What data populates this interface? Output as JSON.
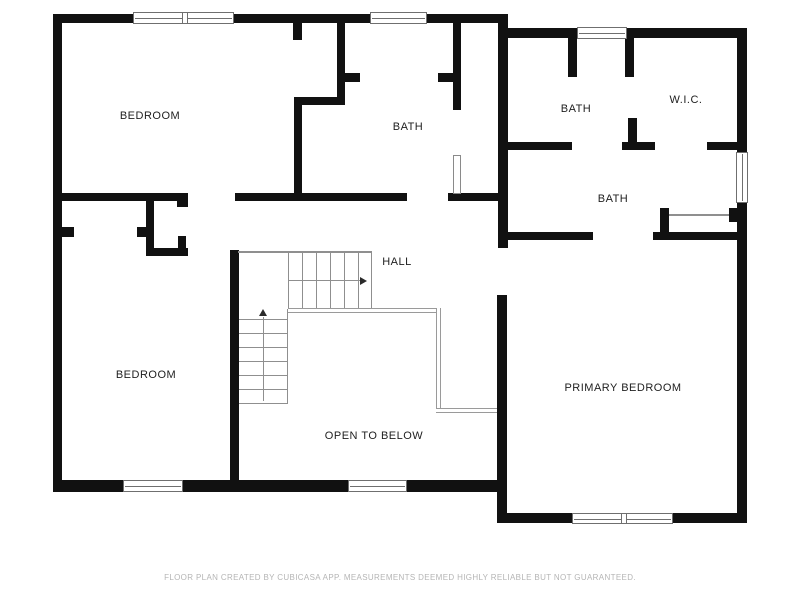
{
  "rooms": {
    "bedroom_tl": {
      "label": "BEDROOM"
    },
    "bath_mid": {
      "label": "BATH"
    },
    "bath_tr": {
      "label": "BATH"
    },
    "wic": {
      "label": "W.I.C."
    },
    "bath_right": {
      "label": "BATH"
    },
    "hall": {
      "label": "HALL"
    },
    "bedroom_bl": {
      "label": "BEDROOM"
    },
    "open_below": {
      "label": "OPEN TO BELOW"
    },
    "primary": {
      "label": "PRIMARY BEDROOM"
    }
  },
  "footer": {
    "disclaimer": "FLOOR PLAN CREATED BY CUBICASA APP. MEASUREMENTS DEEMED HIGHLY RELIABLE BUT NOT GUARANTEED."
  },
  "colors": {
    "wall": "#111111",
    "stair_line": "#8f8f8f",
    "label_text": "#1e1e1e",
    "footer_text": "#b5b5b5",
    "window_frame": "#6f6f6f"
  }
}
